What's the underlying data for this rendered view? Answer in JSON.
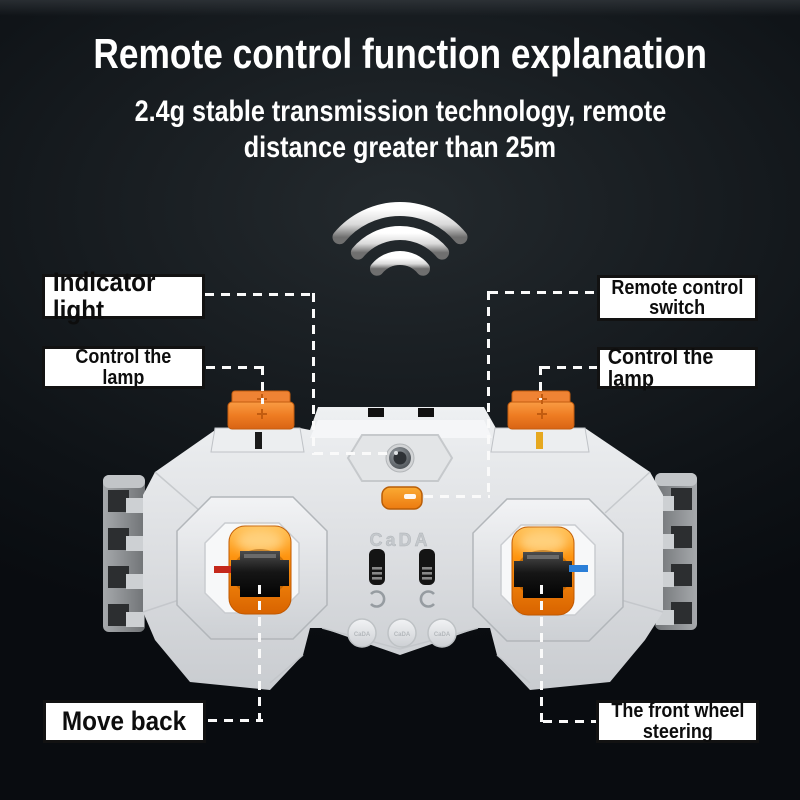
{
  "header": {
    "title": "Remote control function explanation",
    "subtitle_line1": "2.4g stable transmission technology, remote",
    "subtitle_line2": "distance greater than 25m"
  },
  "callouts": {
    "indicator_light": {
      "label": "Indicator light"
    },
    "control_lamp_left": {
      "line1": "Control the",
      "line2": "lamp"
    },
    "remote_switch": {
      "line1": "Remote control",
      "line2": "switch"
    },
    "control_lamp_right": {
      "label": "Control the lamp"
    },
    "move_back": {
      "label": "Move back"
    },
    "front_wheel_steering": {
      "line1": "The front wheel",
      "line2": "steering"
    }
  },
  "device": {
    "brand": "CaDA",
    "small_button_label": "CaDA"
  },
  "icons": {
    "wifi": "wifi-signal-icon"
  },
  "colors": {
    "background": "#101418",
    "accent_orange": "#f07d1a",
    "joystick_glow": "#ff9c1e",
    "label_bg": "#ffffff",
    "label_text": "#0d0d0d",
    "connector_line": "#fafafa",
    "red_mark": "#c5281b",
    "blue_mark": "#2b7fd8",
    "body_gray": "#dfe1e4"
  }
}
